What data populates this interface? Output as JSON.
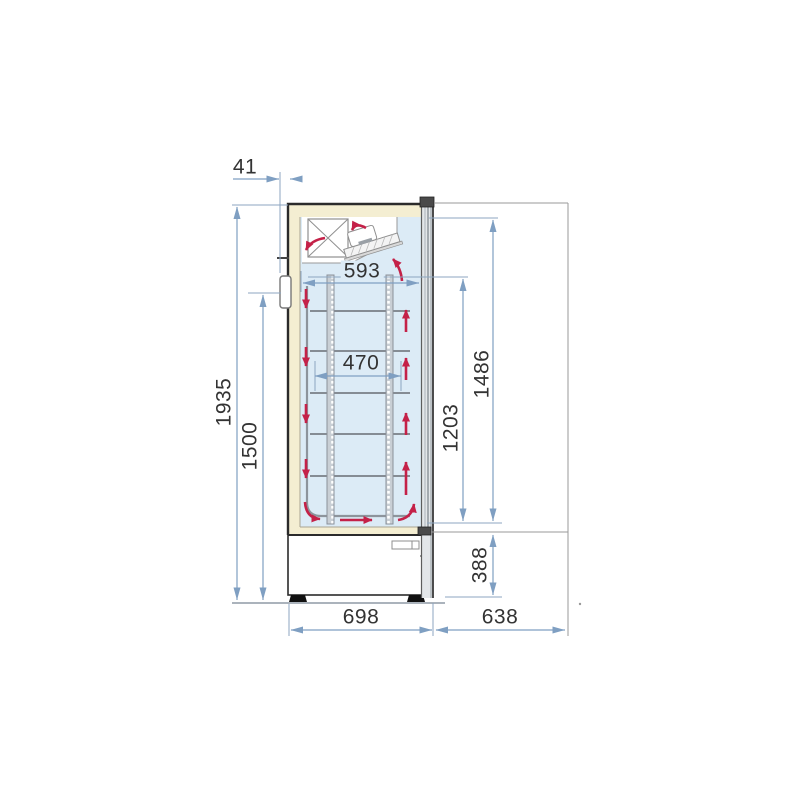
{
  "diagram": {
    "title": "refrigerator-side-view-dimension-drawing",
    "unit": "mm",
    "labels": {
      "rear_clearance": "41",
      "interior_depth": "593",
      "shelf_depth": "470",
      "total_height": "1935",
      "hinge_height": "1500",
      "interior_height": "1486",
      "shelf_zone_height": "1203",
      "base_height": "388",
      "cabinet_depth": "698",
      "door_clearance": "638"
    },
    "colors": {
      "dimension_line": "#7f9fc2",
      "reference_line": "#9a9a9a",
      "airflow_arrow": "#c42148",
      "insulation": "#f4eed2",
      "interior": "#dcebf6",
      "outline": "#2b2b2b"
    }
  }
}
